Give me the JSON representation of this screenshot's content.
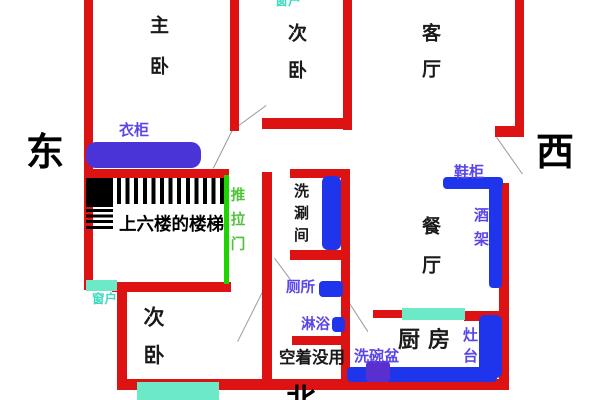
{
  "title": "apartment floor plan sketch",
  "colors": {
    "wall": "#dd1212",
    "fixture_blue": "#1f35ec",
    "furniture_violet": "#4a34d8",
    "sink_purple": "#5a2fd0",
    "window_cyan": "#6ceac8",
    "door_green": "#1ed400",
    "label_blue": "#5a46e8",
    "label_cyan": "#3ddbc0",
    "label_green": "#4fc43a",
    "door_swing_gray": "#9a9a9a"
  },
  "compass": {
    "east": "东",
    "west": "西",
    "north": "北"
  },
  "rooms": {
    "master_bedroom": "主卧",
    "second_bedroom_top": "次卧",
    "living_room": "客厅",
    "dining_room": "餐厅",
    "second_bedroom_bottom": "次卧",
    "kitchen": "厨房",
    "washroom": "洗涮间",
    "unused_space": "空着没用",
    "stairs_note": "上六楼的楼梯"
  },
  "fixtures": {
    "wardrobe": "衣柜",
    "shoe_cabinet": "鞋柜",
    "wine_rack": "酒架",
    "toilet": "厕所",
    "shower": "淋浴",
    "dish_sink": "洗碗盆",
    "stove": "灶台",
    "sliding_door": "推拉门",
    "window_top": "窗户",
    "window_bottom_left": "窗户"
  }
}
